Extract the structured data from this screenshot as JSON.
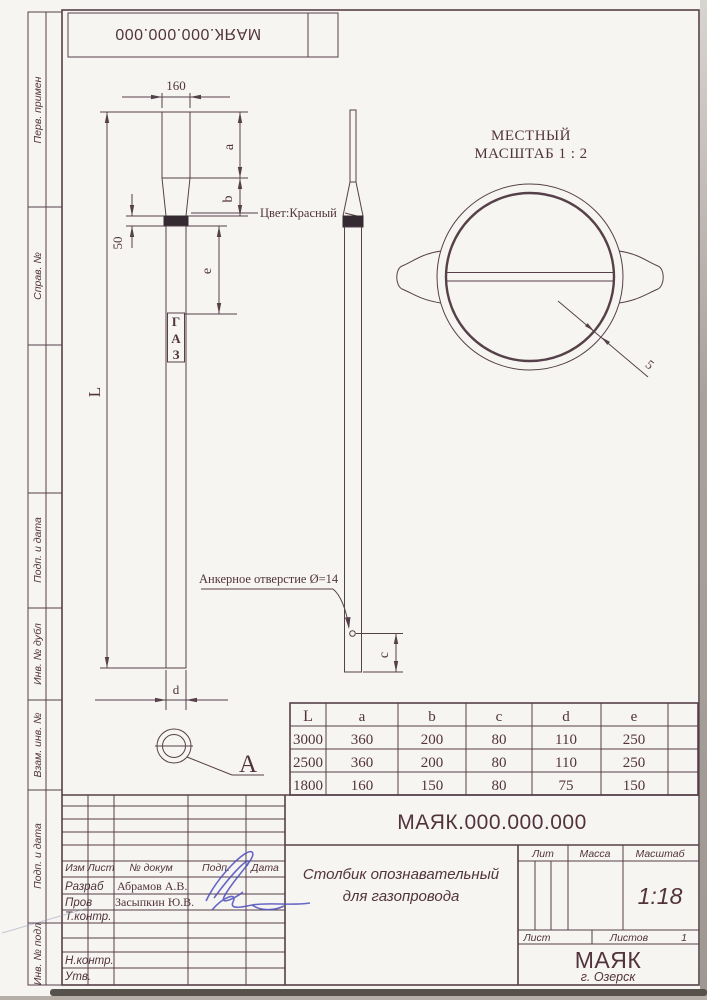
{
  "colors": {
    "ink_line": "#564049",
    "ink_text": "#52333d",
    "band_fill": "#352a31",
    "signature_blue": "#4d4fbe",
    "paper": "#f6f5f2"
  },
  "top_stamp": {
    "code": "МАЯК.000.000.000"
  },
  "margin": {
    "labels": [
      "Перв. примен",
      "Справ. №",
      "Подп. и дата",
      "Инв. № дубл",
      "Взам. инв. №",
      "Подп. и дата",
      "Инв. № подл"
    ]
  },
  "front_view": {
    "dim_width": "160",
    "dim_band": "50",
    "dim_length": "L",
    "dim_a": "a",
    "dim_b": "b",
    "dim_e": "e",
    "dim_d": "d",
    "color_note": "Цвет:Красный",
    "gaz": [
      "Г",
      "А",
      "З"
    ]
  },
  "side_view": {
    "anchor_note": "Анкерное отверстие  Ø=14",
    "dim_c": "c"
  },
  "detail_a": {
    "label": "А"
  },
  "local_view": {
    "title1": "МЕСТНЫЙ",
    "title2": "МАСШТАБ 1 : 2",
    "thickness": "5"
  },
  "size_table": {
    "headers": [
      "L",
      "a",
      "b",
      "c",
      "d",
      "e"
    ],
    "rows": [
      [
        "3000",
        "360",
        "200",
        "80",
        "110",
        "250"
      ],
      [
        "2500",
        "360",
        "200",
        "80",
        "110",
        "250"
      ],
      [
        "1800",
        "160",
        "150",
        "80",
        "75",
        "150"
      ]
    ]
  },
  "title_block": {
    "doc_number": "МАЯК.000.000.000",
    "product_line1": "Столбик опознавательный",
    "product_line2": "для газопровода",
    "rev_headers": [
      "Изм",
      "Лист",
      "№ докум",
      "Подп.",
      "Дата"
    ],
    "row_razrab": "Разраб",
    "row_prov": "Пров",
    "row_tkontr": "Т.контр.",
    "row_nkontr": "Н.контр.",
    "row_utv": "Утв.",
    "name_razrab": "Абрамов А.В.",
    "name_prov": "Засыпкин Ю.В.",
    "lit_label": "Лит",
    "mass_label": "Масса",
    "scale_label": "Масштаб",
    "scale_value": "1:18",
    "sheet_label": "Лист",
    "sheets_label": "Листов",
    "sheets_value": "1",
    "company": "МАЯК",
    "city": "г. Озерск"
  }
}
